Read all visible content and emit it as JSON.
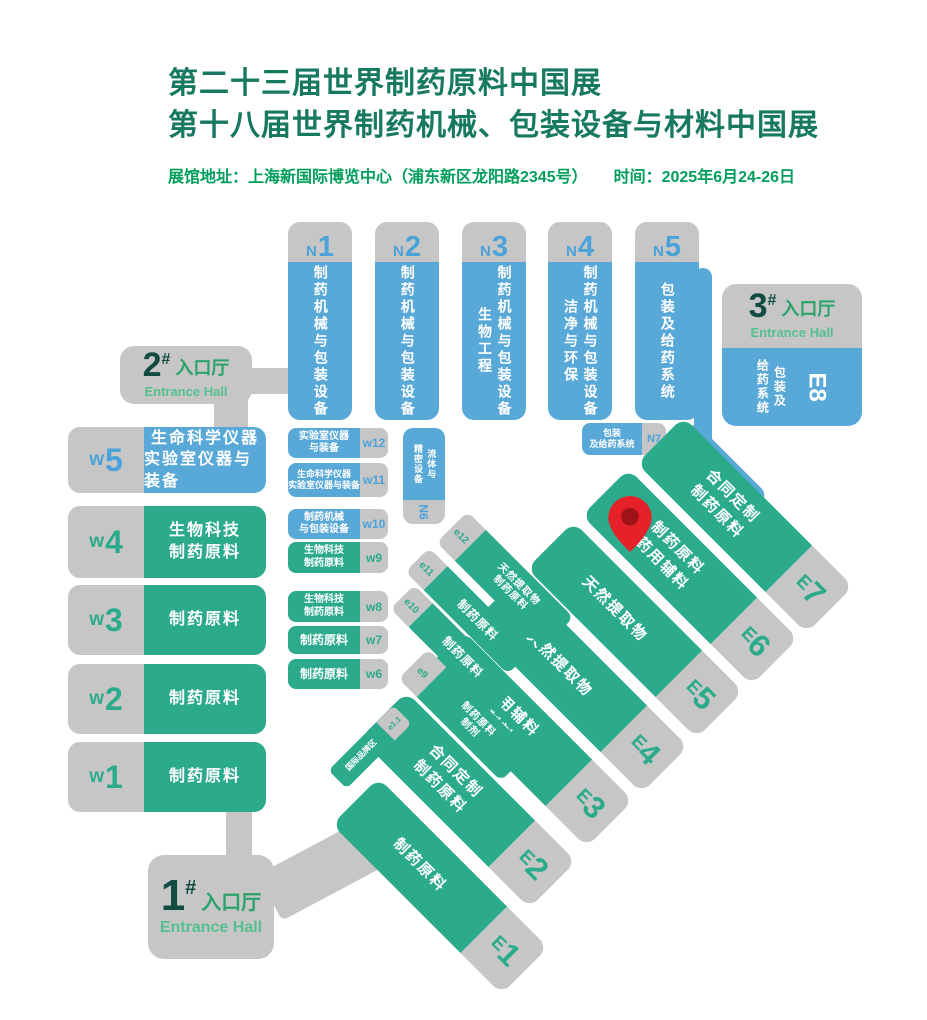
{
  "header": {
    "title_line1": "第二十三届世界制药原料中国展",
    "title_line2": "第十八届世界制药机械、包装设备与材料中国展",
    "info_address": "展馆地址：上海新国际博览中心（浦东新区龙阳路2345号）",
    "info_time": "时间：2025年6月24-26日"
  },
  "colors": {
    "hall_green": "#2bab8c",
    "hall_blue": "#58a8d8",
    "hall_gray": "#c6c6c7",
    "title_green": "#17795f",
    "info_green": "#009e5a",
    "entrance_number": "#114b41",
    "pin_red": "#e62129",
    "pin_inner": "#9e1316"
  },
  "entrance_1": {
    "number": "1",
    "hash": "#",
    "name_cn": "入口厅",
    "name_en": "Entrance Hall"
  },
  "entrance_2": {
    "number": "2",
    "hash": "#",
    "name_cn": "入口厅",
    "name_en": "Entrance Hall"
  },
  "entrance_3": {
    "number": "3",
    "hash": "#",
    "name_cn": "入口厅",
    "name_en": "Entrance Hall"
  },
  "north_halls": [
    {
      "prefix": "N",
      "number": "1",
      "lines": [
        "制药机械与包装设备"
      ]
    },
    {
      "prefix": "N",
      "number": "2",
      "lines": [
        "制药机械与包装设备"
      ]
    },
    {
      "prefix": "N",
      "number": "3",
      "lines": [
        "制药机械与包装设备",
        "生物工程"
      ]
    },
    {
      "prefix": "N",
      "number": "4",
      "lines": [
        "制药机械与包装设备",
        "洁净与环保"
      ]
    },
    {
      "prefix": "N",
      "number": "5",
      "lines": [
        "包装及给药系统"
      ]
    }
  ],
  "west_large": [
    {
      "prefix": "w",
      "number": "5",
      "lines": [
        "生命科学仪器",
        "实验室仪器与装备"
      ]
    },
    {
      "prefix": "w",
      "number": "4",
      "lines": [
        "生物科技",
        "制药原料"
      ]
    },
    {
      "prefix": "w",
      "number": "3",
      "lines": [
        "制药原料"
      ]
    },
    {
      "prefix": "w",
      "number": "2",
      "lines": [
        "制药原料"
      ]
    },
    {
      "prefix": "w",
      "number": "1",
      "lines": [
        "制药原料"
      ]
    }
  ],
  "west_small": [
    {
      "label": "w12",
      "lines": [
        "实验室仪器",
        "与装备"
      ]
    },
    {
      "label": "w11",
      "lines": [
        "生命科学仪器",
        "实验室仪器与装备"
      ]
    },
    {
      "label": "w10",
      "lines": [
        "制药机械",
        "与包装设备"
      ]
    },
    {
      "label": "w9",
      "lines": [
        "生物科技",
        "制药原料"
      ]
    },
    {
      "label": "w8",
      "lines": [
        "生物科技",
        "制药原料"
      ]
    },
    {
      "label": "w7",
      "lines": [
        "制药原料"
      ]
    },
    {
      "label": "w6",
      "lines": [
        "制药原料"
      ]
    }
  ],
  "hall_n6": {
    "label": "N6",
    "lines": [
      "流体与",
      "精密设备"
    ]
  },
  "hall_n7": {
    "label": "N7",
    "lines": [
      "包装",
      "及给药系统"
    ]
  },
  "hall_e8": {
    "label": "E8",
    "lines": [
      "包装及",
      "给药系统"
    ]
  },
  "east_large": [
    {
      "prefix": "E",
      "number": "1",
      "lines": [
        "制药原料"
      ]
    },
    {
      "prefix": "E",
      "number": "2",
      "lines": [
        "合同定制",
        "制药原料"
      ]
    },
    {
      "prefix": "E",
      "number": "3",
      "lines": [
        "药用辅料",
        "制剂"
      ]
    },
    {
      "prefix": "E",
      "number": "4",
      "lines": [
        "天然提取物"
      ]
    },
    {
      "prefix": "E",
      "number": "5",
      "lines": [
        "天然提取物"
      ]
    },
    {
      "prefix": "E",
      "number": "6",
      "lines": [
        "制药原料",
        "药用辅料"
      ]
    },
    {
      "prefix": "E",
      "number": "7",
      "lines": [
        "合同定制",
        "制药原料"
      ]
    }
  ],
  "east_small": [
    {
      "label": "e12",
      "lines": [
        "天然提取物",
        "制药原料"
      ]
    },
    {
      "label": "e11",
      "lines": [
        "制药原料"
      ]
    },
    {
      "label": "e10",
      "lines": [
        "制药原料"
      ]
    },
    {
      "label": "e9",
      "lines": [
        "制药原料",
        "制剂"
      ]
    }
  ],
  "brand_zone": {
    "label": "e1.1",
    "lines": [
      "国际品牌区"
    ]
  }
}
